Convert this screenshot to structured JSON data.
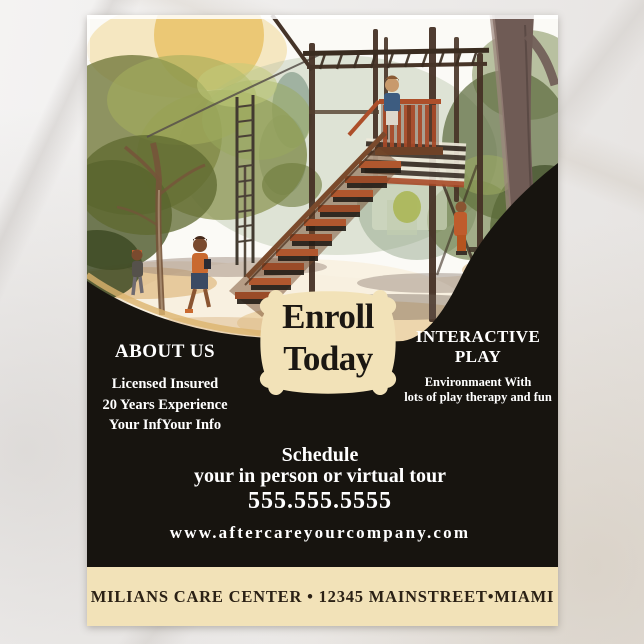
{
  "product": {
    "surface": "marble-backdrop",
    "item": "care center advertising flyer"
  },
  "flyer": {
    "illustration_alt": "Watercolor painting of a wooden playground climbing tower with stairs, monkey bars, trees and children playing",
    "badge": {
      "line1": "Enroll",
      "line2": "Today"
    },
    "about": {
      "heading": "ABOUT US",
      "line1": "Licensed Insured",
      "line2": "20 Years Experience",
      "line3": "Your InfYour Info"
    },
    "interactive": {
      "heading_line1": "INTERACTIVE",
      "heading_line2": "PLAY",
      "line1": "Environmaent With",
      "line2": "lots of play therapy and fun"
    },
    "schedule": {
      "heading": "Schedule",
      "subheading": "your in person or virtual tour",
      "phone": "555.555.5555",
      "website": "www.aftercareyourcompany.com"
    },
    "footer": {
      "text": "MILIANS CARE CENTER • 12345 MAINSTREET•MIAMI"
    },
    "colors": {
      "cream": "#f2e2b8",
      "black_panel": "#17140f",
      "text_light": "#ffffff",
      "text_dark": "#2b2115"
    }
  }
}
